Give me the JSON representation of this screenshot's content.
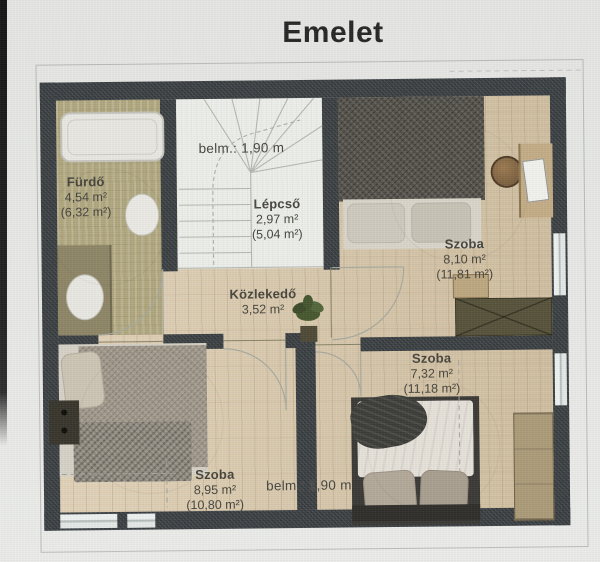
{
  "title": "Emelet",
  "rooms": [
    {
      "name": "Fürdő",
      "area": "4,54 m²",
      "area_secondary": "(6,32 m²)"
    },
    {
      "name": "Lépcső",
      "area": "2,97 m²",
      "area_secondary": "(5,04 m²)"
    },
    {
      "name": "Közlekedő",
      "area": "3,52 m²",
      "area_secondary": ""
    },
    {
      "name": "Szoba",
      "area": "8,10 m²",
      "area_secondary": "(11,81 m²)"
    },
    {
      "name": "Szoba",
      "area": "7,32 m²",
      "area_secondary": "(11,18 m²)"
    },
    {
      "name": "Szoba",
      "area": "8,95 m²",
      "area_secondary": "(10,80 m²)"
    }
  ],
  "annotations": {
    "ceiling_height_top": "belm.: 1,90 m",
    "ceiling_height_bottom": "belm.: 1,90 m"
  },
  "colors": {
    "wall": "#3e4347",
    "wood_floor": "#d9c8a9",
    "bathroom_floor": "#b0a77e",
    "stairs_floor": "#eef0ec",
    "background": "#e9eae7",
    "label_ink": "#46443c",
    "title_ink": "#262626"
  }
}
